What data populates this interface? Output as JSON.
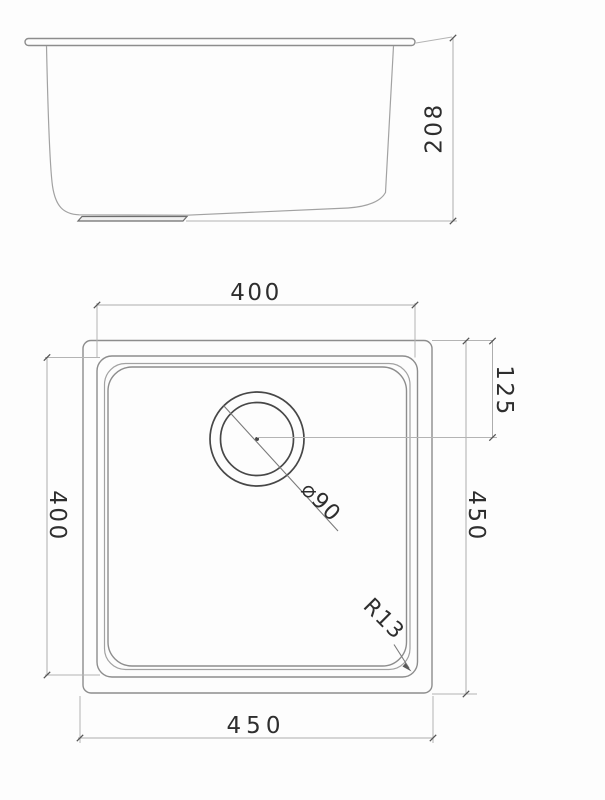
{
  "drawing": {
    "side_view": {
      "depth": "208"
    },
    "plan_view": {
      "inner_width": "400",
      "inner_depth": "400",
      "outer_width": "450",
      "outer_height": "450",
      "drain_offset_from_top": "125",
      "drain_diameter": "⌀90",
      "corner_radius": "R13"
    },
    "colors": {
      "background": "#fdfdfd",
      "object_line": "#8d8d8d",
      "dark_line": "#474747",
      "dimension_line": "#adadad",
      "text": "#2e2e2e"
    }
  }
}
